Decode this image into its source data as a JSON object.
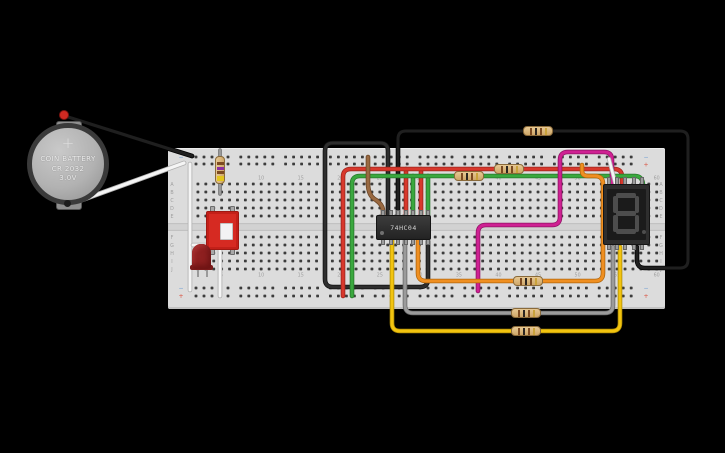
{
  "scene": {
    "background": "#000000",
    "description": "Tinkercad-style breadboard circuit: coin cell battery, pushbutton, red LED, 74HC04 hex-inverter IC, six resistors and a 7-segment display wired together"
  },
  "battery": {
    "line1": "COIN BATTERY",
    "line2": "CR 2032",
    "line3": "3.0V",
    "plus": "+"
  },
  "ic": {
    "label": "74HC04",
    "pins_per_side": 7
  },
  "display7seg": {
    "digit": "8",
    "decimal_point": true,
    "segment_color": "#4d4d4d",
    "pins_per_side": 5
  },
  "breadboard": {
    "column_labels": [
      "1",
      "5",
      "10",
      "15",
      "20",
      "25",
      "30",
      "35",
      "40",
      "45",
      "50",
      "55",
      "60"
    ],
    "column_numbers": [
      1,
      5,
      10,
      15,
      20,
      25,
      30,
      35,
      40,
      45,
      50,
      55,
      60
    ],
    "row_letters_upper": [
      "A",
      "B",
      "C",
      "D",
      "E"
    ],
    "row_letters_lower": [
      "F",
      "G",
      "H",
      "I",
      "J"
    ],
    "rail_minus": "−",
    "rail_plus": "+",
    "colors": {
      "board": "#dcdcdc",
      "hole": "#3c3c3c",
      "label": "#9f9f9f",
      "minus": "#6b9bd2",
      "plus": "#d94f3d"
    }
  },
  "band_colors": {
    "brown": "#7c4a21",
    "black": "#2b2520",
    "gold": "#c9a23a",
    "violet": "#8b2fa0",
    "yellow": "#e3c51d"
  },
  "resistors": [
    {
      "name": "resistor-top-loop",
      "x": 523,
      "y": 126,
      "orientation": "h",
      "bands": [
        "brown",
        "black",
        "brown",
        "gold"
      ]
    },
    {
      "name": "resistor-red-line",
      "x": 494,
      "y": 164,
      "orientation": "h",
      "bands": [
        "brown",
        "black",
        "brown",
        "gold"
      ]
    },
    {
      "name": "resistor-green-line",
      "x": 454,
      "y": 171,
      "orientation": "h",
      "bands": [
        "brown",
        "black",
        "brown",
        "gold"
      ]
    },
    {
      "name": "resistor-orange-line",
      "x": 513,
      "y": 276,
      "orientation": "h",
      "bands": [
        "brown",
        "black",
        "brown",
        "gold"
      ]
    },
    {
      "name": "resistor-gray-line",
      "x": 511,
      "y": 308,
      "orientation": "h",
      "bands": [
        "brown",
        "black",
        "brown",
        "gold"
      ]
    },
    {
      "name": "resistor-yellow-line",
      "x": 511,
      "y": 326,
      "orientation": "h",
      "bands": [
        "brown",
        "black",
        "brown",
        "gold"
      ]
    },
    {
      "name": "resistor-vertical",
      "x": 215,
      "y": 156,
      "orientation": "v",
      "bands": [
        "brown",
        "violet",
        "brown",
        "yellow"
      ]
    }
  ],
  "wires": [
    {
      "name": "lead-vertical-resistor",
      "color": "#9a9a9a",
      "outline": "#6f6f6f",
      "width": 2,
      "path": "M220,150 L220,194"
    },
    {
      "name": "wire-white-left-rail",
      "color": "#f5f5f5",
      "outline": "#b0b0b0",
      "width": 3,
      "path": "M190,164 L190,290"
    },
    {
      "name": "wire-white-button-gnd",
      "color": "#f5f5f5",
      "outline": "#b0b0b0",
      "width": 3,
      "path": "M193,245 L214,245 Q220,245 220,251 L220,296"
    },
    {
      "name": "wire-battery-black",
      "color": "#1f1f1f",
      "outline": "#000000",
      "width": 3.2,
      "path": "M65,116 L192,156"
    },
    {
      "name": "wire-battery-white",
      "color": "#f5f5f5",
      "outline": "#b0b0b0",
      "width": 3.2,
      "path": "M68,205 L184,163"
    },
    {
      "name": "wire-darkgray-loop",
      "color": "#2e2e2e",
      "outline": "#101010",
      "width": 3,
      "path": "M388,217 L388,151 Q388,143 380,143 L333,143 Q325,143 325,151 L325,279 Q325,287 333,287 L420,287 Q428,287 428,279 L428,241"
    },
    {
      "name": "wire-black-top-loop",
      "color": "#1f1f1f",
      "outline": "#000000",
      "width": 3,
      "path": "M398,217 L398,139 Q398,131 406,131 L680,131 Q688,131 688,139 L688,260 Q688,268 680,268 L645,268 Q637,268 637,260 L637,247"
    },
    {
      "name": "wire-red-ic-a",
      "color": "#d8382c",
      "outline": "#9c251c",
      "width": 3,
      "path": "M406,217 L406,169"
    },
    {
      "name": "wire-red-ic-b",
      "color": "#d8382c",
      "outline": "#9c251c",
      "width": 3,
      "path": "M421,217 L421,169"
    },
    {
      "name": "wire-green-ic-a",
      "color": "#3aa83e",
      "outline": "#27762a",
      "width": 3,
      "path": "M413,217 L413,176"
    },
    {
      "name": "wire-green-ic-b",
      "color": "#3aa83e",
      "outline": "#27762a",
      "width": 3,
      "path": "M428,217 L428,176"
    },
    {
      "name": "wire-red-main",
      "color": "#d8382c",
      "outline": "#9c251c",
      "width": 3,
      "path": "M343,296 L343,177 Q343,169 351,169 L614,169 Q622,169 622,177 L622,186"
    },
    {
      "name": "wire-green-main",
      "color": "#3aa83e",
      "outline": "#27762a",
      "width": 3,
      "path": "M352,296 L352,184 Q352,176 360,176 L635,176 Q643,176 643,186"
    },
    {
      "name": "wire-brown",
      "color": "#9a6a42",
      "outline": "#6b4526",
      "width": 3,
      "path": "M368,157 L368,183 Q368,196 376,200 Q383,205 383,211 L383,217"
    },
    {
      "name": "wire-magenta",
      "color": "#cf2193",
      "outline": "#8f1263",
      "width": 3,
      "path": "M478,291 L478,233 Q478,225 486,225 L552,225 Q560,225 560,217 L560,160 Q560,152 568,152 L604,152 Q612,152 612,160 L612,186"
    },
    {
      "name": "wire-orange",
      "color": "#ef8f21",
      "outline": "#b0660c",
      "width": 3,
      "path": "M418,240 L418,273 Q418,281 426,281 L595,281 Q603,281 603,273 L603,184 Q603,176 595,176 L588,176 Q582,176 582,171 L582,165"
    },
    {
      "name": "wire-gray-loop",
      "color": "#9b9b9b",
      "outline": "#686868",
      "width": 3,
      "path": "M405,240 L405,305 Q405,313 413,313 L605,313 Q613,313 613,305 L613,247"
    },
    {
      "name": "wire-yellow-loop",
      "color": "#f2c40f",
      "outline": "#b08d06",
      "width": 3,
      "path": "M392,240 L392,323 Q392,331 400,331 L612,331 Q620,331 620,323 L620,247"
    },
    {
      "name": "wire-white-7seg",
      "color": "#f5f5f5",
      "outline": "#b0b0b0",
      "width": 2.6,
      "path": "M609,159 L616,186"
    }
  ]
}
